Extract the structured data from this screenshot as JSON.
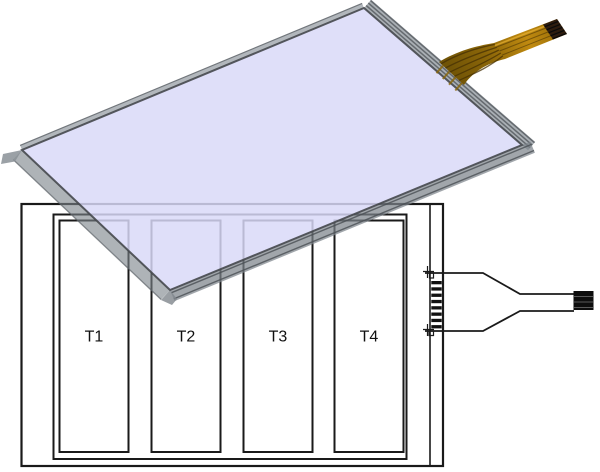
{
  "figure": {
    "zones": [
      {
        "label": "T1"
      },
      {
        "label": "T2"
      },
      {
        "label": "T3"
      },
      {
        "label": "T4"
      }
    ],
    "colors": {
      "panel_face": "#d9d9f8",
      "panel_edge_gray": "#8a9096",
      "flex_cable_gold": "#b0800a",
      "cable_tip_brown": "#2e1c0e",
      "line_black": "#1a1a1a",
      "background": "#ffffff"
    }
  }
}
